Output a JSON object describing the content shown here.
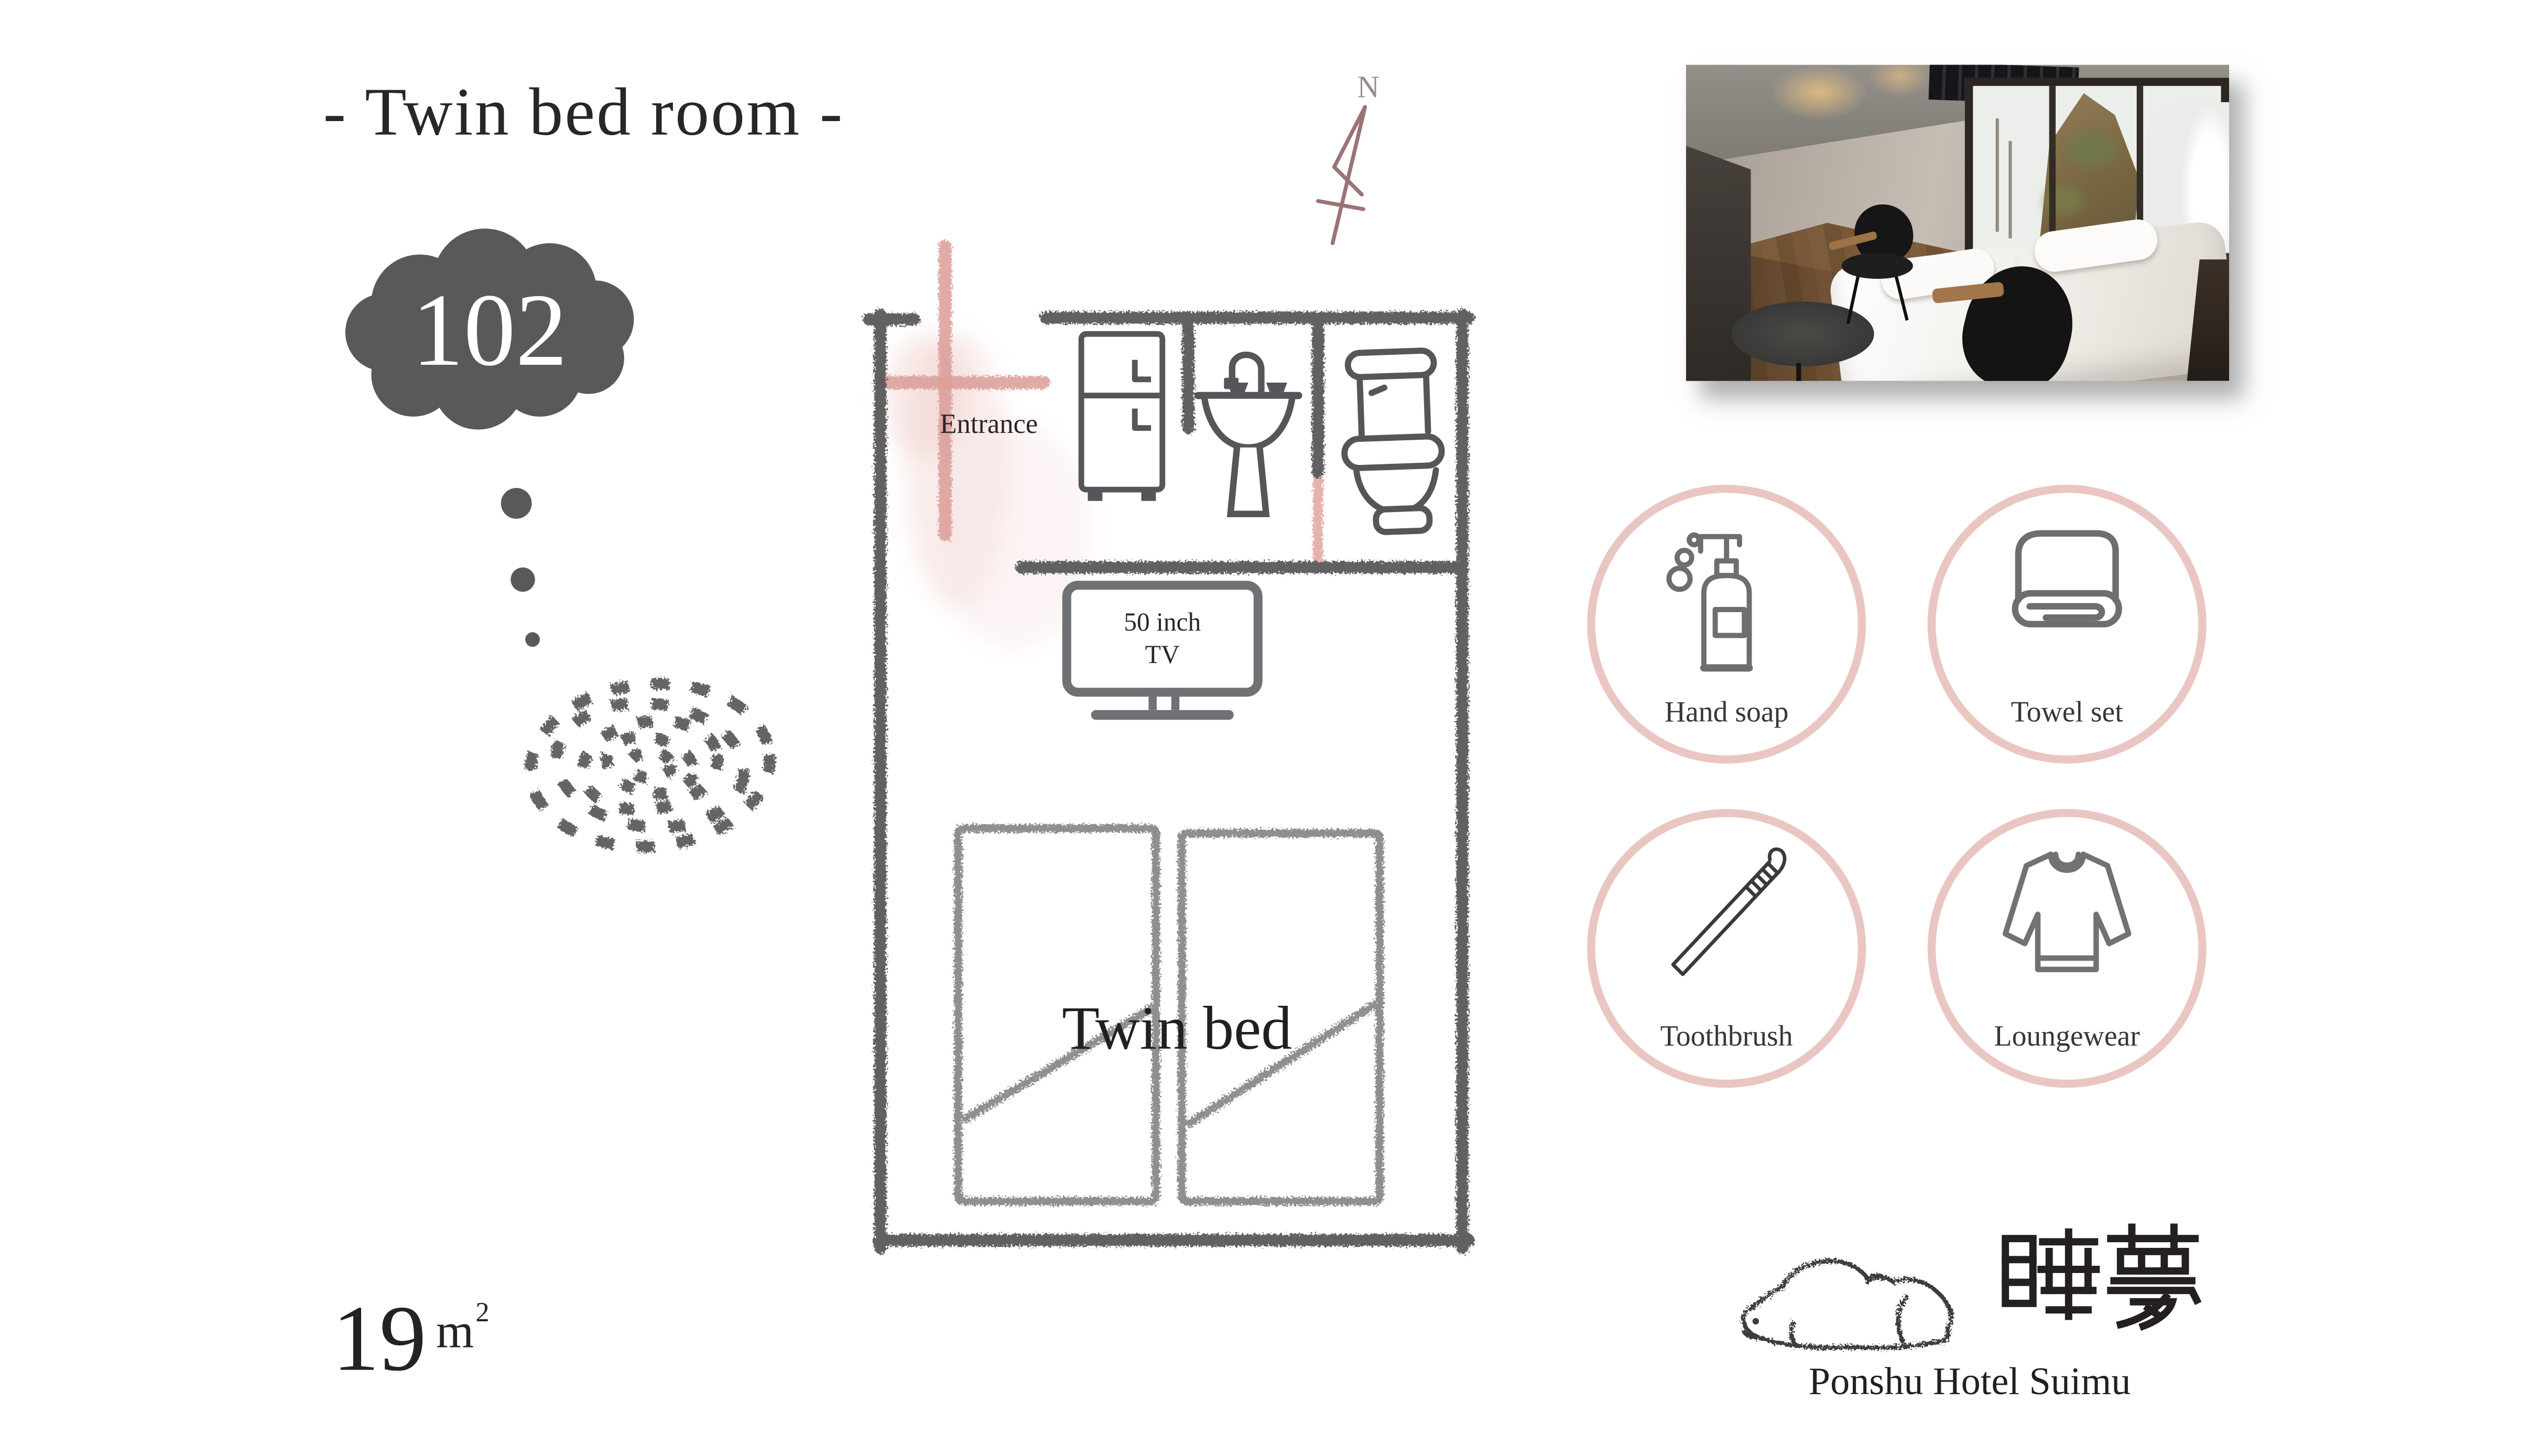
{
  "header": {
    "title": "- Twin bed room -"
  },
  "room": {
    "number": "102",
    "area_value": "19",
    "area_unit": "m",
    "area_exponent": "2"
  },
  "floor_plan": {
    "compass_label": "N",
    "entrance_label": "Entrance",
    "tv_label_line1": "50 inch",
    "tv_label_line2": "TV",
    "bed_label": "Twin bed"
  },
  "amenities": [
    {
      "label": "Hand soap",
      "icon": "soap-bottle-icon"
    },
    {
      "label": "Towel set",
      "icon": "towel-icon"
    },
    {
      "label": "Toothbrush",
      "icon": "toothbrush-icon"
    },
    {
      "label": "Loungewear",
      "icon": "loungewear-icon"
    }
  ],
  "logo": {
    "kanji": "睡夢",
    "hotel_name": "Ponshu Hotel Suimu"
  },
  "colors": {
    "accent_pink": "#eac6c3",
    "door_pink": "#db9d97",
    "wall_gray": "#565656",
    "icon_gray": "#55565a",
    "cloud_gray": "#58595b",
    "text_dark": "#262223",
    "compass_rose": "#9b7376"
  }
}
